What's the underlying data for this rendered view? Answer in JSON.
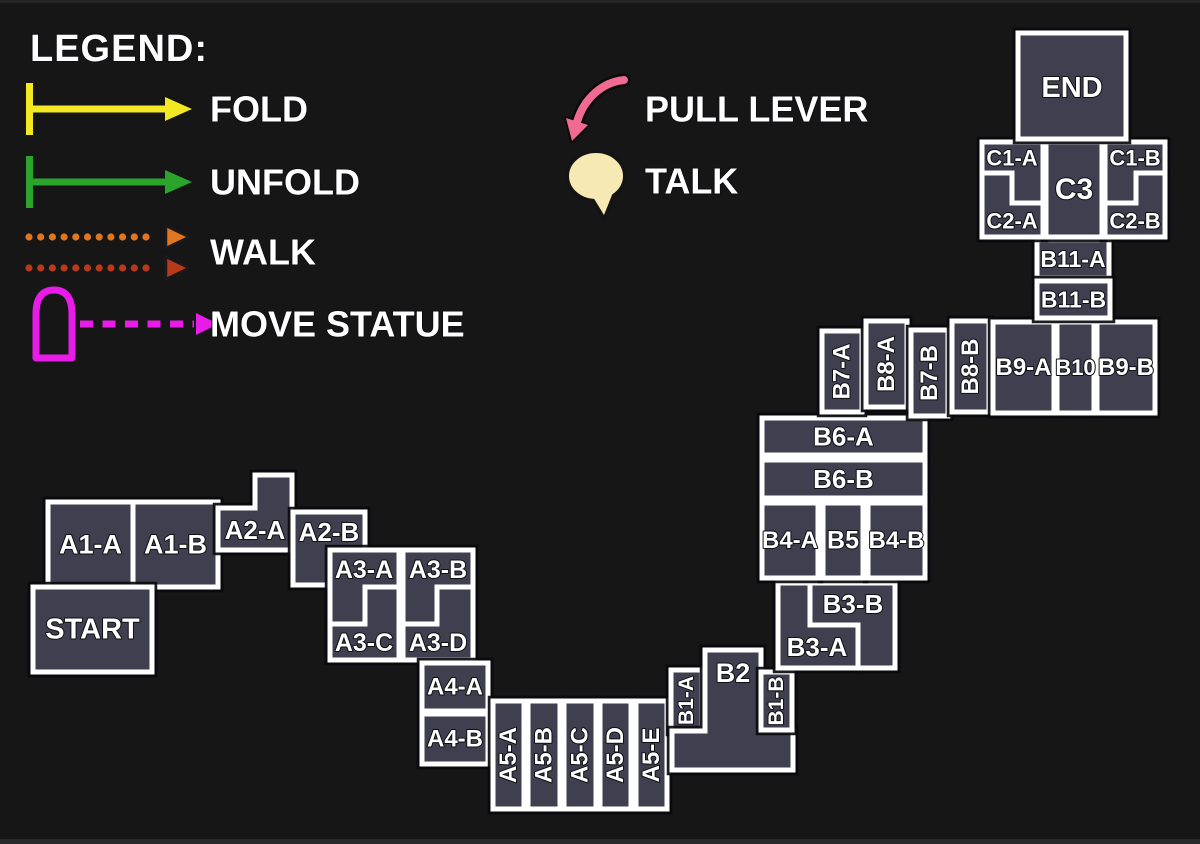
{
  "canvas": {
    "width": 1200,
    "height": 844,
    "background": "#161616",
    "room_fill": "#3F3F4F",
    "room_stroke": "#FFFFFF",
    "top_edge": "#242427",
    "bottom_edge": "#29292C"
  },
  "legend": {
    "title": "LEGEND:",
    "items": [
      {
        "id": "fold",
        "label": "FOLD",
        "icon": "yellow-bar-arrow-icon",
        "type": "bar-arrow",
        "color": "#F2E823",
        "y": 109,
        "text_x": 210
      },
      {
        "id": "unfold",
        "label": "UNFOLD",
        "icon": "green-bar-arrow-icon",
        "type": "bar-arrow",
        "color": "#2AA42A",
        "y": 182,
        "text_x": 210
      },
      {
        "id": "walk",
        "label": "WALK",
        "icon": "double-dotted-arrow-icon",
        "type": "dotted-pair",
        "color": "#E0761F",
        "color2": "#B93A1B",
        "y": 252,
        "y1": 237,
        "y2": 268,
        "text_x": 210
      },
      {
        "id": "move-statue",
        "label": "MOVE STATUE",
        "icon": "statue-dashed-arrow-icon",
        "type": "statue-dash",
        "color": "#E81BE8",
        "y": 324,
        "text_x": 210
      },
      {
        "id": "pull-lever",
        "label": "PULL LEVER",
        "icon": "pink-curved-arrow-icon",
        "type": "curved-arrow",
        "color": "#F16A92",
        "y": 109,
        "text_x": 645
      },
      {
        "id": "talk",
        "label": "TALK",
        "icon": "speech-bubble-icon",
        "type": "bubble",
        "color": "#F7E9B4",
        "y": 181,
        "text_x": 645
      }
    ]
  },
  "blocks": [
    {
      "id": "a1",
      "rooms": [
        {
          "id": "a1-a",
          "label": "A1-A",
          "r": [
            48,
            502,
            85,
            85
          ],
          "fs": 27
        },
        {
          "id": "a1-b",
          "label": "A1-B",
          "r": [
            133,
            502,
            85,
            85
          ],
          "fs": 27
        }
      ]
    },
    {
      "id": "start",
      "rooms": [
        {
          "id": "start",
          "label": "START",
          "r": [
            33,
            587,
            119,
            85
          ],
          "fs": 29
        }
      ]
    },
    {
      "id": "a2a",
      "rooms": [
        {
          "id": "a2-a",
          "label": "A2-A",
          "pts": [
            [
              255,
              475
            ],
            [
              292,
              475
            ],
            [
              292,
              550
            ],
            [
              218,
              550
            ],
            [
              218,
              508
            ],
            [
              255,
              508
            ]
          ],
          "lx": 255,
          "ly": 530,
          "fs": 26
        }
      ]
    },
    {
      "id": "a2b",
      "rooms": [
        {
          "id": "a2-b",
          "label": "A2-B",
          "r": [
            293,
            512,
            72,
            73
          ],
          "lx": 329,
          "ly": 532,
          "fs": 26
        }
      ]
    },
    {
      "id": "a3",
      "rooms": [
        {
          "id": "a3-a",
          "label": "A3-A",
          "pts": [
            [
              330,
              550
            ],
            [
              399,
              550
            ],
            [
              399,
              587
            ],
            [
              365,
              587
            ],
            [
              365,
              624
            ],
            [
              330,
              624
            ]
          ],
          "lx": 364,
          "ly": 570,
          "fs": 25
        },
        {
          "id": "a3-b",
          "label": "A3-B",
          "pts": [
            [
              403,
              550
            ],
            [
              473,
              550
            ],
            [
              473,
              587
            ],
            [
              437,
              587
            ],
            [
              437,
              624
            ],
            [
              403,
              624
            ]
          ],
          "lx": 438,
          "ly": 570,
          "fs": 25
        },
        {
          "id": "a3-c",
          "label": "A3-C",
          "pts": [
            [
              365,
              587
            ],
            [
              399,
              587
            ],
            [
              399,
              660
            ],
            [
              330,
              660
            ],
            [
              330,
              624
            ],
            [
              365,
              624
            ]
          ],
          "lx": 364,
          "ly": 643,
          "fs": 25
        },
        {
          "id": "a3-d",
          "label": "A3-D",
          "pts": [
            [
              437,
              587
            ],
            [
              473,
              587
            ],
            [
              473,
              660
            ],
            [
              403,
              660
            ],
            [
              403,
              624
            ],
            [
              437,
              624
            ]
          ],
          "lx": 438,
          "ly": 643,
          "fs": 25
        }
      ]
    },
    {
      "id": "a4",
      "rooms": [
        {
          "id": "a4-a",
          "label": "A4-A",
          "r": [
            422,
            663,
            66,
            48
          ],
          "fs": 24
        },
        {
          "id": "a4-b",
          "label": "A4-B",
          "r": [
            422,
            714,
            66,
            50
          ],
          "fs": 24
        }
      ]
    },
    {
      "id": "a5",
      "rooms": [
        {
          "id": "a5-a",
          "label": "A5-A",
          "r": [
            493,
            701,
            31,
            108
          ],
          "rot": true,
          "fs": 24
        },
        {
          "id": "a5-b",
          "label": "A5-B",
          "r": [
            528,
            701,
            32,
            108
          ],
          "rot": true,
          "fs": 24
        },
        {
          "id": "a5-c",
          "label": "A5-C",
          "r": [
            564,
            701,
            32,
            108
          ],
          "rot": true,
          "fs": 24
        },
        {
          "id": "a5-d",
          "label": "A5-D",
          "r": [
            600,
            701,
            31,
            108
          ],
          "rot": true,
          "fs": 24
        },
        {
          "id": "a5-e",
          "label": "A5-E",
          "r": [
            636,
            701,
            31,
            108
          ],
          "rot": true,
          "fs": 24
        }
      ]
    },
    {
      "id": "b1a",
      "rooms": [
        {
          "id": "b1-a",
          "label": "B1-A",
          "r": [
            671,
            670,
            31,
            61
          ],
          "rot": true,
          "fs": 21
        }
      ]
    },
    {
      "id": "b2",
      "rooms": [
        {
          "id": "b2",
          "label": "B2",
          "pts": [
            [
              705,
              650
            ],
            [
              761,
              650
            ],
            [
              761,
              731
            ],
            [
              793,
              731
            ],
            [
              793,
              770
            ],
            [
              672,
              770
            ],
            [
              672,
              731
            ],
            [
              705,
              731
            ]
          ],
          "lx": 733,
          "ly": 673,
          "fs": 27
        }
      ]
    },
    {
      "id": "b1b",
      "rooms": [
        {
          "id": "b1-b",
          "label": "B1-B",
          "r": [
            761,
            672,
            31,
            58
          ],
          "rot": true,
          "fs": 21
        }
      ]
    },
    {
      "id": "b3",
      "rooms": [
        {
          "id": "b3-a",
          "label": "B3-A",
          "pts": [
            [
              778,
              583
            ],
            [
              810,
              583
            ],
            [
              810,
              625
            ],
            [
              858,
              625
            ],
            [
              858,
              668
            ],
            [
              778,
              668
            ]
          ],
          "lx": 817,
          "ly": 647,
          "fs": 26
        },
        {
          "id": "b3-b",
          "label": "B3-B",
          "pts": [
            [
              810,
              583
            ],
            [
              895,
              583
            ],
            [
              895,
              668
            ],
            [
              858,
              668
            ],
            [
              858,
              625
            ],
            [
              810,
              625
            ]
          ],
          "lx": 853,
          "ly": 604,
          "fs": 26
        }
      ]
    },
    {
      "id": "b6",
      "rooms": [
        {
          "id": "b6-a",
          "label": "B6-A",
          "r": [
            762,
            418,
            163,
            37
          ],
          "fs": 26
        },
        {
          "id": "b6-b",
          "label": "B6-B",
          "r": [
            762,
            460,
            163,
            38
          ],
          "fs": 26
        },
        {
          "id": "b4-a",
          "label": "B4-A",
          "r": [
            762,
            503,
            56,
            75
          ],
          "fs": 24
        },
        {
          "id": "b5",
          "label": "B5",
          "r": [
            823,
            503,
            40,
            75
          ],
          "fs": 25
        },
        {
          "id": "b4-b",
          "label": "B4-B",
          "r": [
            868,
            503,
            57,
            75
          ],
          "fs": 24
        }
      ]
    },
    {
      "id": "b7a",
      "rooms": [
        {
          "id": "b7-a",
          "label": "B7-A",
          "r": [
            822,
            331,
            40,
            81
          ],
          "rot": true,
          "fs": 24
        }
      ]
    },
    {
      "id": "b8a",
      "rooms": [
        {
          "id": "b8-a",
          "label": "B8-A",
          "r": [
            866,
            321,
            41,
            86
          ],
          "rot": true,
          "fs": 24
        }
      ]
    },
    {
      "id": "b7b",
      "rooms": [
        {
          "id": "b7-b",
          "label": "B7-B",
          "r": [
            911,
            330,
            37,
            86
          ],
          "rot": true,
          "fs": 24
        }
      ]
    },
    {
      "id": "b8b",
      "rooms": [
        {
          "id": "b8-b",
          "label": "B8-B",
          "r": [
            952,
            321,
            37,
            91
          ],
          "rot": true,
          "fs": 24
        }
      ]
    },
    {
      "id": "b9",
      "rooms": [
        {
          "id": "b9-a",
          "label": "B9-A",
          "r": [
            993,
            322,
            61,
            91
          ],
          "fs": 24
        },
        {
          "id": "b10",
          "label": "B10",
          "r": [
            1057,
            322,
            37,
            91
          ],
          "fs": 22
        },
        {
          "id": "b9-b",
          "label": "B9-B",
          "r": [
            1097,
            322,
            58,
            91
          ],
          "fs": 24
        }
      ]
    },
    {
      "id": "b11a",
      "rooms": [
        {
          "id": "b11-a",
          "label": "B11-A",
          "r": [
            1037,
            240,
            72,
            38
          ],
          "fs": 23
        }
      ]
    },
    {
      "id": "b11b",
      "rooms": [
        {
          "id": "b11-b",
          "label": "B11-B",
          "r": [
            1037,
            281,
            73,
            37
          ],
          "fs": 23
        }
      ]
    },
    {
      "id": "c",
      "rooms": [
        {
          "id": "c1-a",
          "label": "C1-A",
          "pts": [
            [
              982,
              142
            ],
            [
              1043,
              142
            ],
            [
              1043,
              203
            ],
            [
              1012,
              203
            ],
            [
              1012,
              173
            ],
            [
              982,
              173
            ]
          ],
          "lx": 1012,
          "ly": 158,
          "fs": 22
        },
        {
          "id": "c2-a",
          "label": "C2-A",
          "pts": [
            [
              982,
              173
            ],
            [
              1012,
              173
            ],
            [
              1012,
              203
            ],
            [
              1043,
              203
            ],
            [
              1043,
              237
            ],
            [
              982,
              237
            ]
          ],
          "lx": 1012,
          "ly": 221,
          "fs": 22
        },
        {
          "id": "c3",
          "label": "C3",
          "r": [
            1046,
            142,
            56,
            95
          ],
          "fs": 30
        },
        {
          "id": "c1-b",
          "label": "C1-B",
          "pts": [
            [
              1105,
              142
            ],
            [
              1165,
              142
            ],
            [
              1165,
              173
            ],
            [
              1136,
              173
            ],
            [
              1136,
              203
            ],
            [
              1105,
              203
            ]
          ],
          "lx": 1135,
          "ly": 158,
          "fs": 22
        },
        {
          "id": "c2-b",
          "label": "C2-B",
          "pts": [
            [
              1136,
              173
            ],
            [
              1165,
              173
            ],
            [
              1165,
              237
            ],
            [
              1105,
              237
            ],
            [
              1105,
              203
            ],
            [
              1136,
              203
            ]
          ],
          "lx": 1135,
          "ly": 221,
          "fs": 22
        }
      ]
    },
    {
      "id": "end",
      "rooms": [
        {
          "id": "end",
          "label": "END",
          "r": [
            1018,
            33,
            108,
            106
          ],
          "lx": 1072,
          "ly": 88,
          "fs": 29
        }
      ]
    }
  ]
}
